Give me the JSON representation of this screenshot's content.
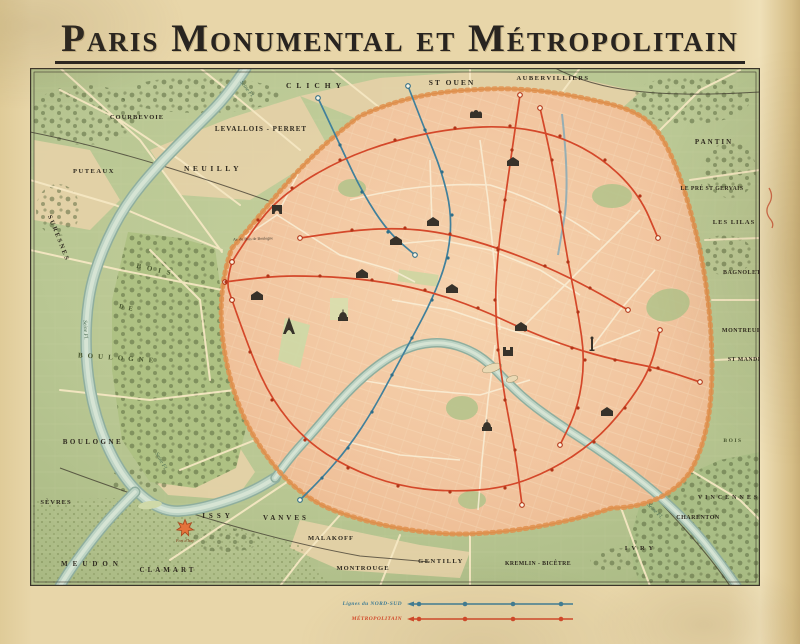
{
  "title": "Paris Monumental et Métropolitain",
  "legend": {
    "items": [
      {
        "label": "Lignes du NORD-SUD",
        "color": "#3f7d96"
      },
      {
        "label": "MÉTROPOLITAIN",
        "color": "#d4482a"
      }
    ]
  },
  "colors": {
    "paper": "#e8d6a9",
    "terrain": "#b9c793",
    "city": "#f2c6a0",
    "wall": "#e0904e",
    "metro": "#d4482a",
    "nordsud": "#41809b",
    "seine": "#bdd3c4",
    "ink": "#37322a",
    "road": "#f4e7c2",
    "rail": "#3c372c"
  },
  "map": {
    "town_labels": [
      {
        "t": "COURBEVOIE",
        "x": 137,
        "y": 119,
        "s": 6.5,
        "ls": 1
      },
      {
        "t": "LEVALLOIS - PERRET",
        "x": 261,
        "y": 131,
        "s": 7,
        "ls": 1
      },
      {
        "t": "NEUILLY",
        "x": 213,
        "y": 171,
        "s": 7.5,
        "ls": 3.5
      },
      {
        "t": "PUTEAUX",
        "x": 94,
        "y": 173,
        "s": 6.5,
        "ls": 1.5
      },
      {
        "t": "CLICHY",
        "x": 316,
        "y": 88,
        "s": 7.5,
        "ls": 5
      },
      {
        "t": "ST OUEN",
        "x": 452,
        "y": 85,
        "s": 7.5,
        "ls": 2
      },
      {
        "t": "AUBERVILLIERS",
        "x": 553,
        "y": 80,
        "s": 6.5,
        "ls": 1.5
      },
      {
        "t": "PANTIN",
        "x": 714,
        "y": 144,
        "s": 7,
        "ls": 2
      },
      {
        "t": "LE PRÉ ST GERVAIS",
        "x": 712,
        "y": 190,
        "s": 5.8,
        "ls": 0.4
      },
      {
        "t": "LES LILAS",
        "x": 734,
        "y": 224,
        "s": 6.5,
        "ls": 1
      },
      {
        "t": "BAGNOLET",
        "x": 742,
        "y": 274,
        "s": 6,
        "ls": 0.5
      },
      {
        "t": "MONTREUIL",
        "x": 743,
        "y": 332,
        "s": 6,
        "ls": 0.5
      },
      {
        "t": "ST MANDÉ",
        "x": 745,
        "y": 361,
        "s": 5.8,
        "ls": 0.5
      },
      {
        "t": "BOIS",
        "x": 733,
        "y": 442,
        "s": 5.5,
        "ls": 1.5,
        "c": "bois"
      },
      {
        "t": "VINCENNES",
        "x": 729,
        "y": 499,
        "s": 6,
        "ls": 3
      },
      {
        "t": "CHARENTON",
        "x": 698,
        "y": 519,
        "s": 6,
        "ls": 0.5
      },
      {
        "t": "IVRY",
        "x": 641,
        "y": 550,
        "s": 6.5,
        "ls": 4
      },
      {
        "t": "KREMLIN - BICÊTRE",
        "x": 538,
        "y": 565,
        "s": 5.8,
        "ls": 0.4
      },
      {
        "t": "GENTILLY",
        "x": 441,
        "y": 563,
        "s": 6.5,
        "ls": 1.5
      },
      {
        "t": "MONTROUGE",
        "x": 363,
        "y": 570,
        "s": 6.5,
        "ls": 1
      },
      {
        "t": "MALAKOFF",
        "x": 331,
        "y": 540,
        "s": 6.5,
        "ls": 1
      },
      {
        "t": "VANVES",
        "x": 286,
        "y": 520,
        "s": 7,
        "ls": 3
      },
      {
        "t": "ISSY",
        "x": 218,
        "y": 518,
        "s": 7,
        "ls": 4
      },
      {
        "t": "CLAMART",
        "x": 168,
        "y": 572,
        "s": 7,
        "ls": 3
      },
      {
        "t": "MEUDON",
        "x": 92,
        "y": 566,
        "s": 7,
        "ls": 5
      },
      {
        "t": "SÈVRES",
        "x": 56,
        "y": 504,
        "s": 6.5,
        "ls": 1
      },
      {
        "t": "BOULOGNE",
        "x": 93,
        "y": 444,
        "s": 7,
        "ls": 2.5
      },
      {
        "t": "SURESNES",
        "x": 57,
        "y": 239,
        "s": 6.5,
        "ls": 2,
        "r": 68
      },
      {
        "t": "BOIS",
        "x": 156,
        "y": 272,
        "s": 7,
        "ls": 6,
        "r": 12,
        "c": "bois"
      },
      {
        "t": "DE",
        "x": 128,
        "y": 310,
        "s": 6.5,
        "ls": 5,
        "r": 12,
        "c": "bois"
      },
      {
        "t": "BOULOGNE",
        "x": 118,
        "y": 360,
        "s": 7,
        "ls": 5,
        "r": 4,
        "c": "bois"
      },
      {
        "t": "Av. du Bois de Boulogne",
        "x": 253,
        "y": 240,
        "s": 4,
        "r": -2,
        "c": "tiny"
      }
    ],
    "water_labels": [
      {
        "t": "Seine Fl.",
        "x": 246,
        "y": 90,
        "r": 52
      },
      {
        "t": "Seine Fl.",
        "x": 84,
        "y": 330,
        "r": 87
      },
      {
        "t": "Seine Fl.",
        "x": 160,
        "y": 462,
        "r": 60
      },
      {
        "t": "Seine Fl.",
        "x": 654,
        "y": 512,
        "r": 45
      }
    ],
    "monuments": [
      {
        "n": "arc-de-triomphe",
        "type": "arch",
        "x": 277,
        "y": 214
      },
      {
        "n": "sacre-coeur",
        "type": "basilica",
        "x": 476,
        "y": 118
      },
      {
        "n": "opera-garnier",
        "type": "palace",
        "x": 433,
        "y": 226
      },
      {
        "n": "la-madeleine",
        "type": "palace",
        "x": 396,
        "y": 245
      },
      {
        "n": "louvre",
        "type": "palace",
        "x": 452,
        "y": 293
      },
      {
        "n": "hotel-de-ville",
        "type": "palace",
        "x": 521,
        "y": 331
      },
      {
        "n": "gare-du-nord",
        "type": "palace",
        "x": 513,
        "y": 166
      },
      {
        "n": "gare-de-lyon",
        "type": "palace",
        "x": 607,
        "y": 416
      },
      {
        "n": "trocadero",
        "type": "palace",
        "x": 257,
        "y": 300
      },
      {
        "n": "grand-palais",
        "type": "palace",
        "x": 362,
        "y": 278
      },
      {
        "n": "notre-dame",
        "type": "church",
        "x": 508,
        "y": 356
      },
      {
        "n": "pantheon",
        "type": "dome",
        "x": 487,
        "y": 431
      },
      {
        "n": "invalides",
        "type": "dome",
        "x": 343,
        "y": 321
      },
      {
        "n": "eiffel-tower",
        "type": "tower",
        "x": 289,
        "y": 334
      },
      {
        "n": "bastille-column",
        "type": "column",
        "x": 592,
        "y": 351
      }
    ],
    "fort": {
      "label": "Fort d'Issy",
      "x": 185,
      "y": 528
    },
    "metro_lines": [
      [
        [
          232,
          262
        ],
        [
          258,
          220
        ],
        [
          292,
          188
        ],
        [
          340,
          160
        ],
        [
          395,
          140
        ],
        [
          455,
          128
        ],
        [
          510,
          126
        ],
        [
          560,
          136
        ],
        [
          605,
          160
        ],
        [
          640,
          196
        ],
        [
          658,
          238
        ]
      ],
      [
        [
          232,
          300
        ],
        [
          250,
          352
        ],
        [
          272,
          400
        ],
        [
          305,
          440
        ],
        [
          348,
          468
        ],
        [
          398,
          486
        ],
        [
          450,
          492
        ],
        [
          505,
          488
        ],
        [
          552,
          470
        ],
        [
          594,
          442
        ],
        [
          625,
          408
        ],
        [
          650,
          370
        ],
        [
          660,
          330
        ]
      ],
      [
        [
          225,
          282
        ],
        [
          268,
          276
        ],
        [
          320,
          276
        ],
        [
          372,
          280
        ],
        [
          425,
          290
        ],
        [
          478,
          308
        ],
        [
          525,
          330
        ],
        [
          572,
          348
        ],
        [
          615,
          360
        ],
        [
          658,
          368
        ],
        [
          700,
          382
        ]
      ],
      [
        [
          300,
          238
        ],
        [
          352,
          230
        ],
        [
          405,
          228
        ],
        [
          450,
          234
        ],
        [
          498,
          248
        ],
        [
          545,
          266
        ],
        [
          590,
          288
        ],
        [
          628,
          310
        ]
      ],
      [
        [
          540,
          108
        ],
        [
          552,
          160
        ],
        [
          560,
          212
        ],
        [
          568,
          262
        ],
        [
          578,
          312
        ],
        [
          585,
          360
        ],
        [
          578,
          408
        ],
        [
          560,
          445
        ]
      ],
      [
        [
          520,
          95
        ],
        [
          512,
          150
        ],
        [
          505,
          200
        ],
        [
          498,
          250
        ],
        [
          495,
          300
        ],
        [
          498,
          350
        ],
        [
          505,
          400
        ],
        [
          515,
          450
        ],
        [
          522,
          505
        ]
      ],
      [
        [
          232,
          262
        ],
        [
          226,
          282
        ],
        [
          232,
          300
        ]
      ]
    ],
    "nordsud_lines": [
      [
        [
          408,
          86
        ],
        [
          425,
          130
        ],
        [
          442,
          172
        ],
        [
          452,
          215
        ],
        [
          448,
          258
        ],
        [
          432,
          300
        ],
        [
          412,
          338
        ],
        [
          392,
          375
        ],
        [
          372,
          412
        ],
        [
          348,
          448
        ],
        [
          322,
          478
        ],
        [
          300,
          500
        ]
      ],
      [
        [
          318,
          98
        ],
        [
          340,
          145
        ],
        [
          362,
          192
        ],
        [
          388,
          232
        ],
        [
          415,
          255
        ]
      ]
    ],
    "seine_outer": [
      [
        246,
        68
      ],
      [
        228,
        95
      ],
      [
        195,
        128
      ],
      [
        158,
        165
      ],
      [
        125,
        205
      ],
      [
        102,
        250
      ],
      [
        88,
        295
      ],
      [
        85,
        350
      ],
      [
        92,
        405
      ],
      [
        110,
        455
      ],
      [
        135,
        492
      ],
      [
        165,
        512
      ],
      [
        195,
        510
      ],
      [
        230,
        500
      ],
      [
        255,
        490
      ],
      [
        275,
        478
      ]
    ],
    "seine_spur": [
      [
        135,
        492
      ],
      [
        112,
        515
      ],
      [
        88,
        545
      ],
      [
        70,
        570
      ],
      [
        60,
        586
      ]
    ],
    "seine_city": [
      [
        737,
        586
      ],
      [
        715,
        555
      ],
      [
        690,
        525
      ],
      [
        662,
        498
      ],
      [
        630,
        472
      ],
      [
        596,
        448
      ],
      [
        560,
        425
      ],
      [
        528,
        402
      ],
      [
        505,
        380
      ],
      [
        488,
        362
      ],
      [
        470,
        350
      ],
      [
        445,
        342
      ],
      [
        418,
        344
      ],
      [
        392,
        355
      ],
      [
        365,
        375
      ],
      [
        340,
        400
      ],
      [
        315,
        430
      ],
      [
        292,
        455
      ],
      [
        275,
        478
      ]
    ],
    "canal": [
      [
        562,
        114
      ],
      [
        570,
        185
      ],
      [
        558,
        255
      ]
    ]
  }
}
